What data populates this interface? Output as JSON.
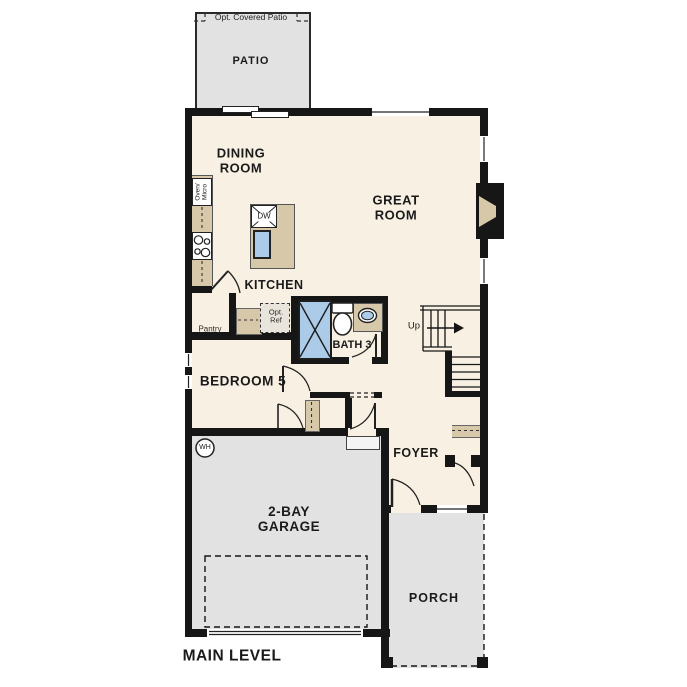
{
  "title": "MAIN LEVEL",
  "colors": {
    "wall": "#161616",
    "floor": "#f8f1e3",
    "outdoor": "#e2e2e2",
    "counter": "#d7c8aa",
    "fixture_blue": "#abcbe9",
    "line": "#222222"
  },
  "rooms": {
    "patio": {
      "label": "PATIO",
      "opt_label": "Opt. Covered Patio"
    },
    "dining": {
      "label": "DINING ROOM"
    },
    "great": {
      "label": "GREAT ROOM"
    },
    "kitchen": {
      "label": "KITCHEN"
    },
    "pantry": {
      "label": "Pantry"
    },
    "bath3": {
      "label": "BATH 3"
    },
    "bedroom5": {
      "label": "BEDROOM 5"
    },
    "foyer": {
      "label": "FOYER"
    },
    "garage": {
      "label": "2-BAY GARAGE"
    },
    "porch": {
      "label": "PORCH"
    }
  },
  "fixtures": {
    "dishwasher": "DW",
    "oven_micro": "Oven/ Micro",
    "opt_ref": "Opt. Ref",
    "water_heater": "WH",
    "stairs_up": "Up"
  }
}
